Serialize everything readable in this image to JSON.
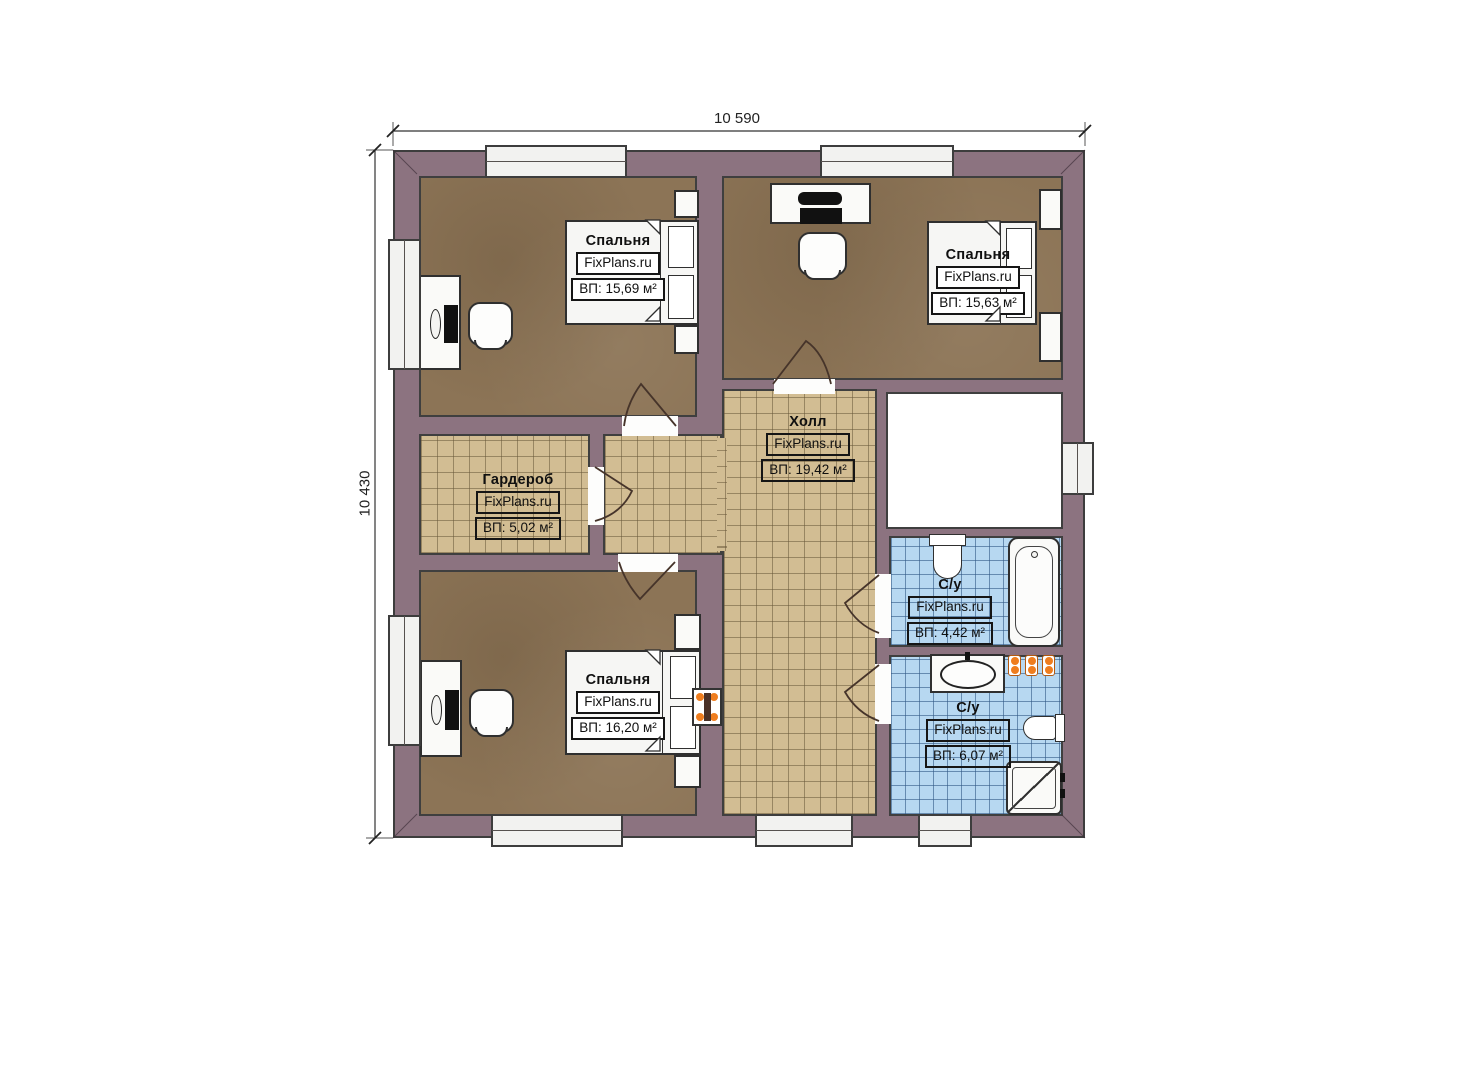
{
  "dims": {
    "top": "10 590",
    "left": "10 430"
  },
  "rooms": {
    "bedroom_tl": {
      "name": "Спальня",
      "brand": "FixPlans.ru",
      "area": "ВП: 15,69 м²"
    },
    "bedroom_tr": {
      "name": "Спальня",
      "brand": "FixPlans.ru",
      "area": "ВП: 15,63 м²"
    },
    "wardrobe": {
      "name": "Гардероб",
      "brand": "FixPlans.ru",
      "area": "ВП: 5,02 м²"
    },
    "hall": {
      "name": "Холл",
      "brand": "FixPlans.ru",
      "area": "ВП: 19,42 м²"
    },
    "bath_upper": {
      "name": "С/у",
      "brand": "FixPlans.ru",
      "area": "ВП: 4,42 м²"
    },
    "bath_lower": {
      "name": "С/у",
      "brand": "FixPlans.ru",
      "area": "ВП: 6,07 м²"
    },
    "bedroom_bl": {
      "name": "Спальня",
      "brand": "FixPlans.ru",
      "area": "ВП: 16,20 м²"
    }
  },
  "colors": {
    "wall": "#8c7380",
    "bedroom_floor": "#8c7456",
    "hall_tile": "#d2bd93",
    "bath_tile": "#b7d8f1",
    "accent_orange": "#ef7d1e",
    "outline": "#3d3d3d"
  }
}
